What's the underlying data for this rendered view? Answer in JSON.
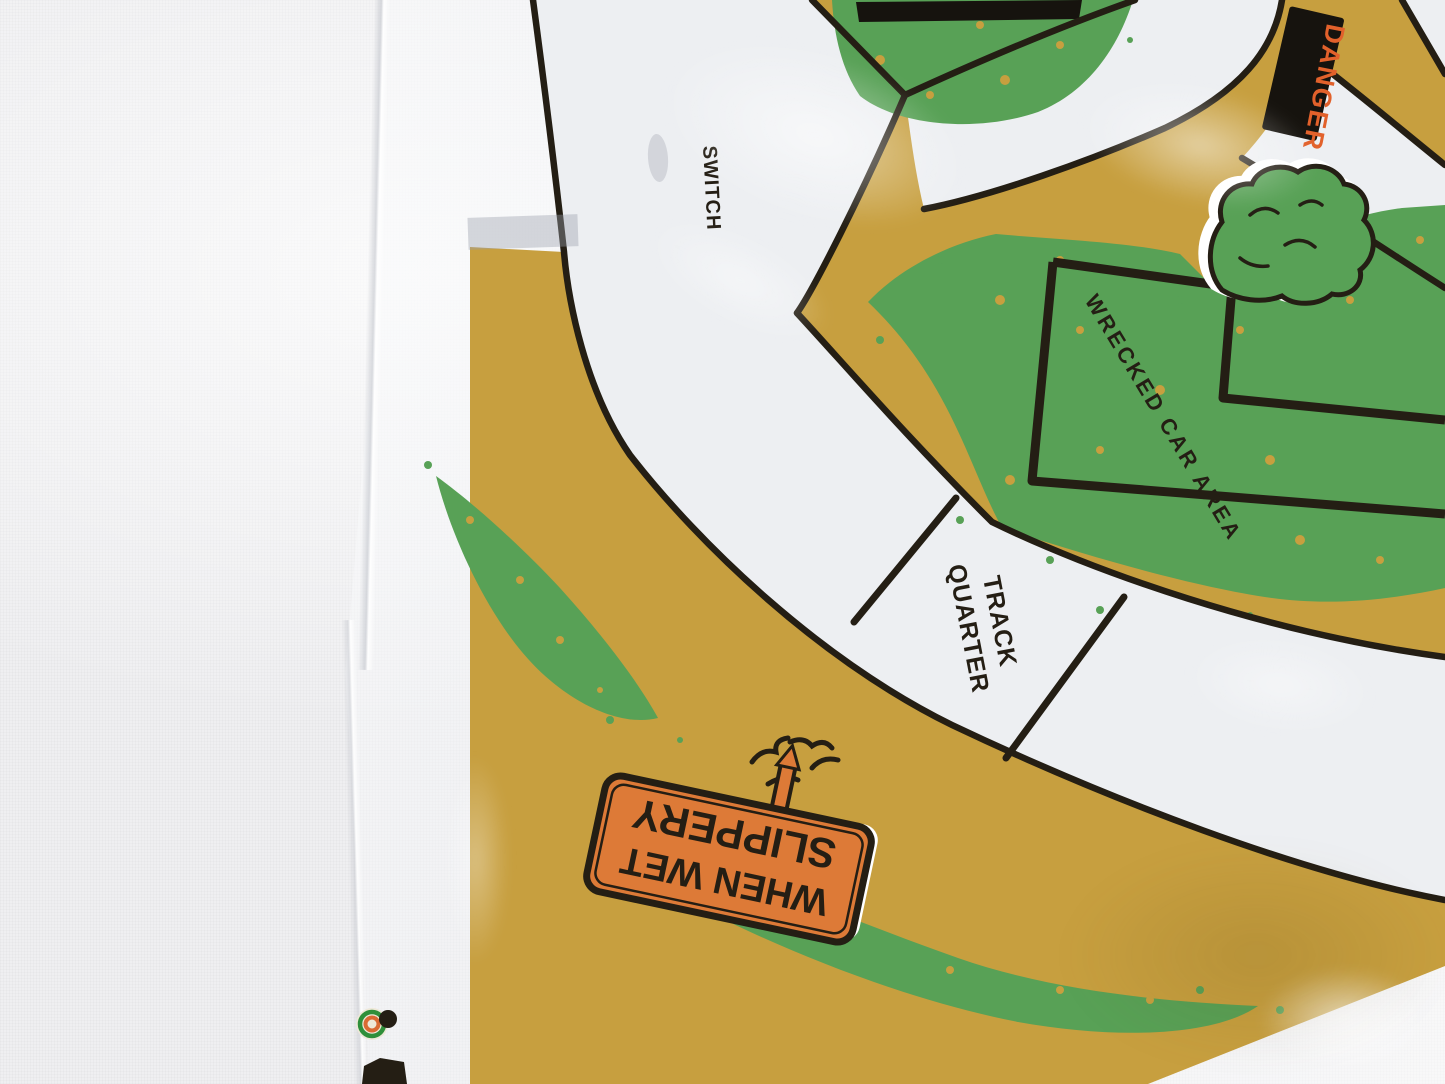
{
  "mat_labels": {
    "switch": "SWITCH",
    "danger": "DANGER",
    "wrecked_car_area": "WRECKED CAR AREA",
    "quarter_track": {
      "line1": "QUARTER",
      "line2": "TRACK"
    },
    "slippery_sign": {
      "line1": "SLIPPERY",
      "line2": "WHEN WET"
    }
  },
  "theme": {
    "colors": {
      "fabric": "#efeff1",
      "plastic": "#f7f8fa",
      "track": "#edeff2",
      "ochre": "#c79f3f",
      "green": "#58a156",
      "line": "#241e14",
      "bar": "#16130e",
      "sign_orange": "#dd7a37",
      "danger_orange": "#e2612b",
      "ring_green": "#2f8f3a",
      "ring_orange": "#d96a33"
    }
  }
}
